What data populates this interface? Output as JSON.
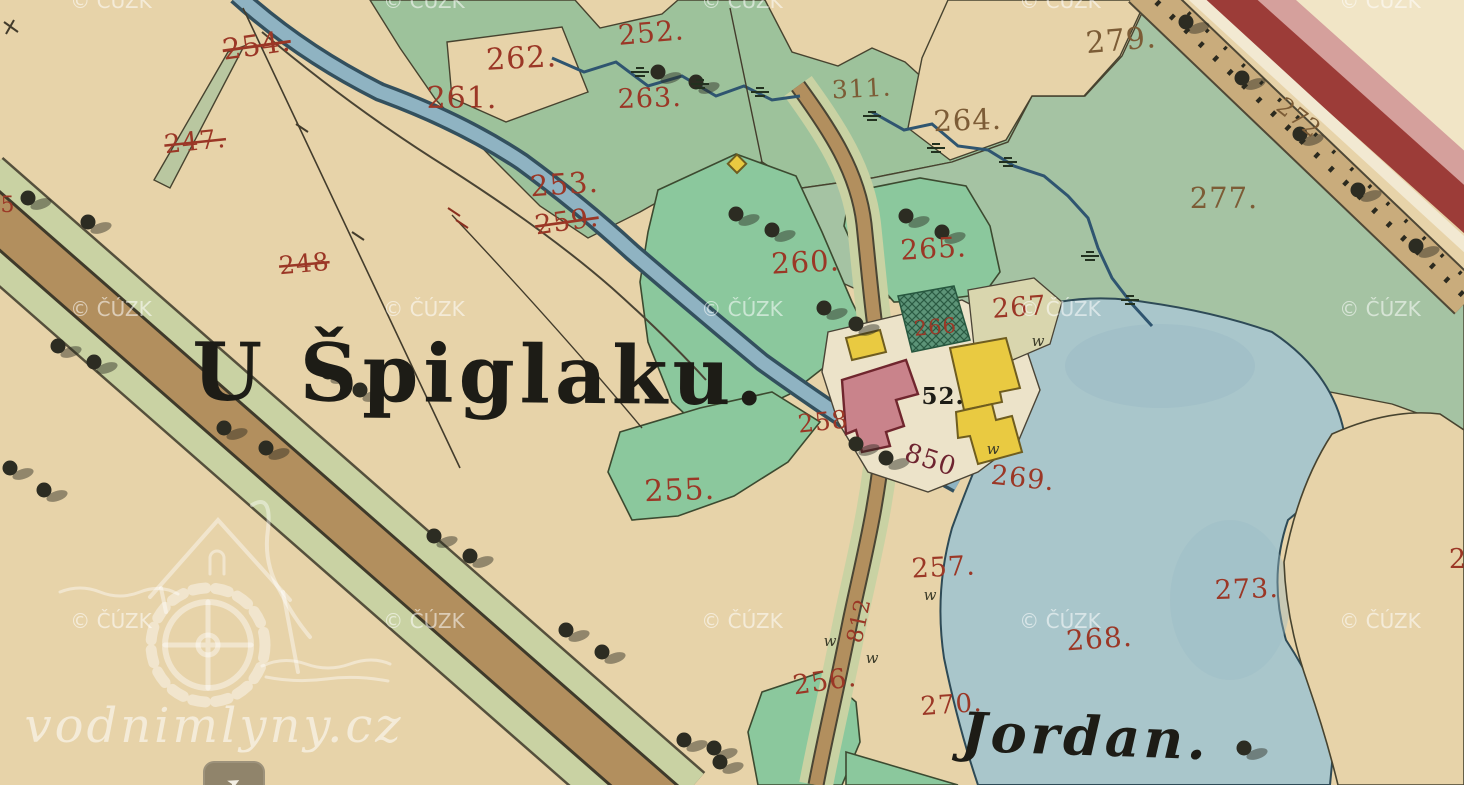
{
  "map": {
    "title_label": {
      "text": "U Špiglaku.",
      "x": 480,
      "y": 402,
      "size": 80,
      "rot": 0.5
    },
    "pond_label": {
      "text": "Jordan.",
      "x": 1085,
      "y": 755,
      "size": 54,
      "rot": 2
    },
    "building_number": {
      "text": "52.",
      "x": 943,
      "y": 404,
      "size": 23,
      "rot": 0
    },
    "parcel_labels": [
      {
        "text": "254.",
        "x": 258,
        "y": 55,
        "size": 29,
        "rot": -8,
        "color": "red",
        "struck": true
      },
      {
        "text": "247.",
        "x": 196,
        "y": 150,
        "size": 26,
        "rot": -6,
        "color": "red",
        "struck": true
      },
      {
        "text": "248",
        "x": 305,
        "y": 272,
        "size": 25,
        "rot": -5,
        "color": "red",
        "struck": true
      },
      {
        "text": "261.",
        "x": 462,
        "y": 108,
        "size": 30,
        "rot": 0,
        "color": "red",
        "struck": false
      },
      {
        "text": "262.",
        "x": 522,
        "y": 68,
        "size": 30,
        "rot": -3,
        "color": "red",
        "struck": false
      },
      {
        "text": "252.",
        "x": 652,
        "y": 42,
        "size": 28,
        "rot": -5,
        "color": "red",
        "struck": false
      },
      {
        "text": "263.",
        "x": 650,
        "y": 107,
        "size": 27,
        "rot": -2,
        "color": "red",
        "struck": false
      },
      {
        "text": "311.",
        "x": 862,
        "y": 97,
        "size": 25,
        "rot": -3,
        "color": "brown",
        "struck": false
      },
      {
        "text": "279.",
        "x": 1122,
        "y": 50,
        "size": 30,
        "rot": -5,
        "color": "brown",
        "struck": false
      },
      {
        "text": "264.",
        "x": 968,
        "y": 130,
        "size": 29,
        "rot": -2,
        "color": "brown",
        "struck": false
      },
      {
        "text": "277.",
        "x": 1224,
        "y": 208,
        "size": 29,
        "rot": 0,
        "color": "brown",
        "struck": false
      },
      {
        "text": "272",
        "x": 1294,
        "y": 124,
        "size": 24,
        "rot": 38,
        "color": "brown",
        "struck": false
      },
      {
        "text": "253.",
        "x": 565,
        "y": 194,
        "size": 29,
        "rot": -4,
        "color": "red",
        "struck": false
      },
      {
        "text": "259.",
        "x": 568,
        "y": 230,
        "size": 27,
        "rot": -8,
        "color": "red",
        "struck": true
      },
      {
        "text": "260.",
        "x": 806,
        "y": 272,
        "size": 29,
        "rot": -3,
        "color": "red",
        "struck": false
      },
      {
        "text": "265.",
        "x": 934,
        "y": 258,
        "size": 28,
        "rot": -3,
        "color": "red",
        "struck": false
      },
      {
        "text": "266",
        "x": 936,
        "y": 334,
        "size": 21,
        "rot": -5,
        "color": "red",
        "struck": false
      },
      {
        "text": "267",
        "x": 1020,
        "y": 316,
        "size": 27,
        "rot": -4,
        "color": "red",
        "struck": false
      },
      {
        "text": "258",
        "x": 824,
        "y": 430,
        "size": 25,
        "rot": -6,
        "color": "red",
        "struck": false
      },
      {
        "text": "850",
        "x": 928,
        "y": 468,
        "size": 26,
        "rot": 18,
        "color": "darkred",
        "struck": false
      },
      {
        "text": "269.",
        "x": 1022,
        "y": 487,
        "size": 27,
        "rot": 6,
        "color": "red",
        "struck": false
      },
      {
        "text": "255.",
        "x": 680,
        "y": 500,
        "size": 30,
        "rot": -2,
        "color": "red",
        "struck": false
      },
      {
        "text": "257.",
        "x": 944,
        "y": 576,
        "size": 27,
        "rot": -3,
        "color": "red",
        "struck": false
      },
      {
        "text": "812",
        "x": 866,
        "y": 622,
        "size": 22,
        "rot": -78,
        "color": "red",
        "struck": false
      },
      {
        "text": "256.",
        "x": 826,
        "y": 690,
        "size": 27,
        "rot": -8,
        "color": "red",
        "struck": false
      },
      {
        "text": "270.",
        "x": 952,
        "y": 713,
        "size": 26,
        "rot": -4,
        "color": "red",
        "struck": false
      },
      {
        "text": "268.",
        "x": 1100,
        "y": 648,
        "size": 28,
        "rot": -4,
        "color": "red",
        "struck": false
      },
      {
        "text": "273.",
        "x": 1247,
        "y": 598,
        "size": 27,
        "rot": -2,
        "color": "red",
        "struck": false
      },
      {
        "text": "2",
        "x": 1458,
        "y": 568,
        "size": 27,
        "rot": 0,
        "color": "red",
        "struck": false
      },
      {
        "text": "5",
        "x": 8,
        "y": 212,
        "size": 22,
        "rot": 0,
        "color": "red",
        "struck": false
      }
    ],
    "colors": {
      "paper": "#e7d3a9",
      "paper-light": "#f1e5c6",
      "meadow": "#9dc29b",
      "meadow2": "#a5c3a3",
      "garden": "#8bc89d",
      "verge": "#c9d2a3",
      "pond": "#a9c6cb",
      "pond-deep": "#9cbcc6",
      "canal": "#8fb3c2",
      "stream": "#2f5570",
      "road-brown": "#b28f5e",
      "avenue": "#c9ac7c",
      "chaussee-red": "#9c3c38",
      "chaussee-pink": "#d5a09c",
      "bldg-red": "#c9838b",
      "bldg-red-stroke": "#70262e",
      "bldg-yellow": "#e9ca41",
      "bldg-yellow-stroke": "#6f5d1f",
      "courtyard": "#ece3c9",
      "label-red": "#9b3726",
      "label-brown": "#7c5c36",
      "label-darkred": "#6e2430",
      "label-black": "#1d1c16"
    }
  },
  "watermarks": {
    "cuzk": {
      "text": "© ČÚZK",
      "cols": [
        111,
        424,
        742,
        1060,
        1380
      ],
      "rows": [
        8,
        316,
        628
      ],
      "size": 20
    },
    "site": {
      "text": "vodnimlyny.cz",
      "x": 214,
      "y": 742,
      "size": 48
    },
    "logo_name": "watermill-house-logo"
  },
  "footer": {
    "share_button_glyph": "➤"
  }
}
